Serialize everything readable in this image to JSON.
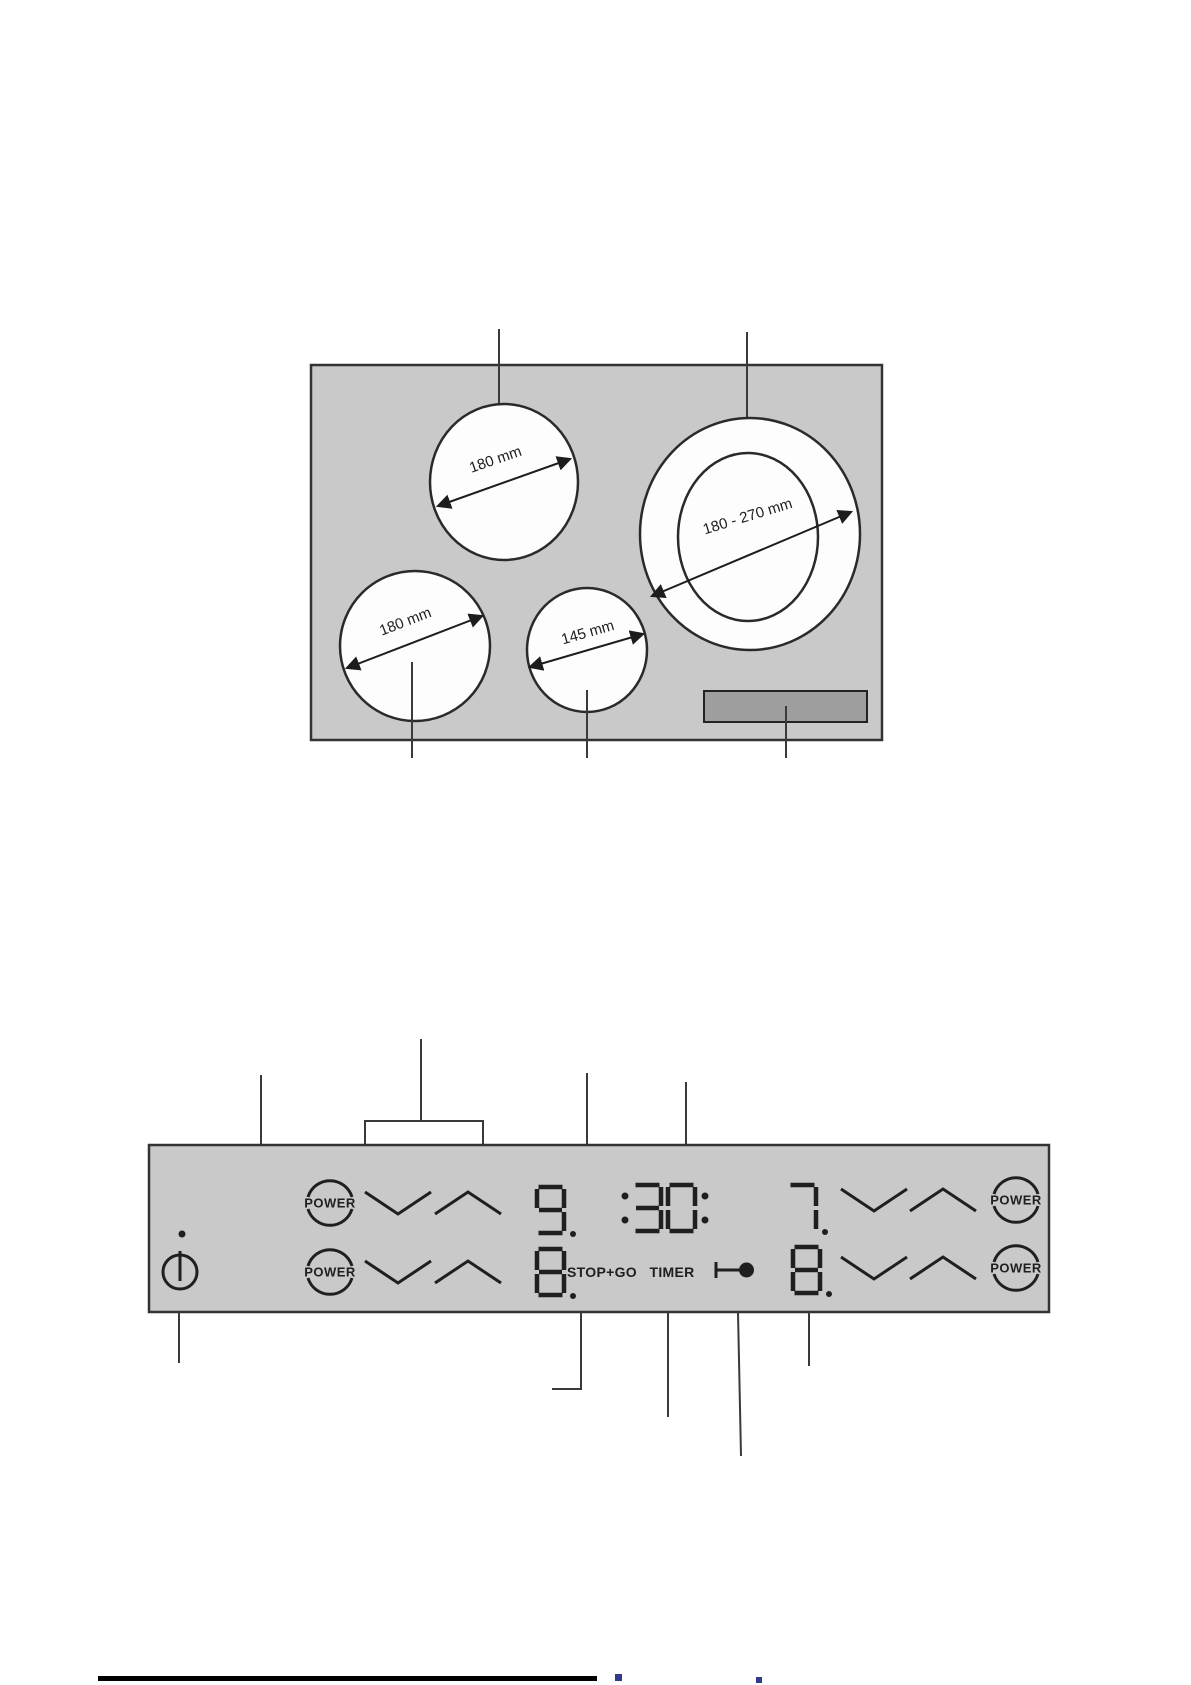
{
  "colors": {
    "paper": "#ffffff",
    "surface": "#c9c9c9",
    "control_area": "#9e9e9e",
    "glyph": "#1f1f1f",
    "line": "#3a3a3a",
    "footer_rule": "#000000",
    "footer_mark": "#333a8c"
  },
  "hob_diagram": {
    "zones": {
      "rear_left": {
        "label": "180 mm"
      },
      "rear_right": {
        "label": "180 - 270 mm"
      },
      "front_left": {
        "label": "180 mm"
      },
      "front_middle": {
        "label": "145 mm"
      }
    }
  },
  "control_panel": {
    "buttons": {
      "power_label": "POWER",
      "stop_go_label": "STOP+GO",
      "timer_label": "TIMER"
    },
    "displays": {
      "rear_left_level": "9.",
      "timer": ":30:",
      "rear_right_level": "7.",
      "front_left_level": "8.",
      "front_right_level": "8."
    },
    "icons": {
      "on_off": "power-on-off-icon",
      "lock": "key-lock-icon",
      "indicator": "indicator-dot"
    }
  }
}
